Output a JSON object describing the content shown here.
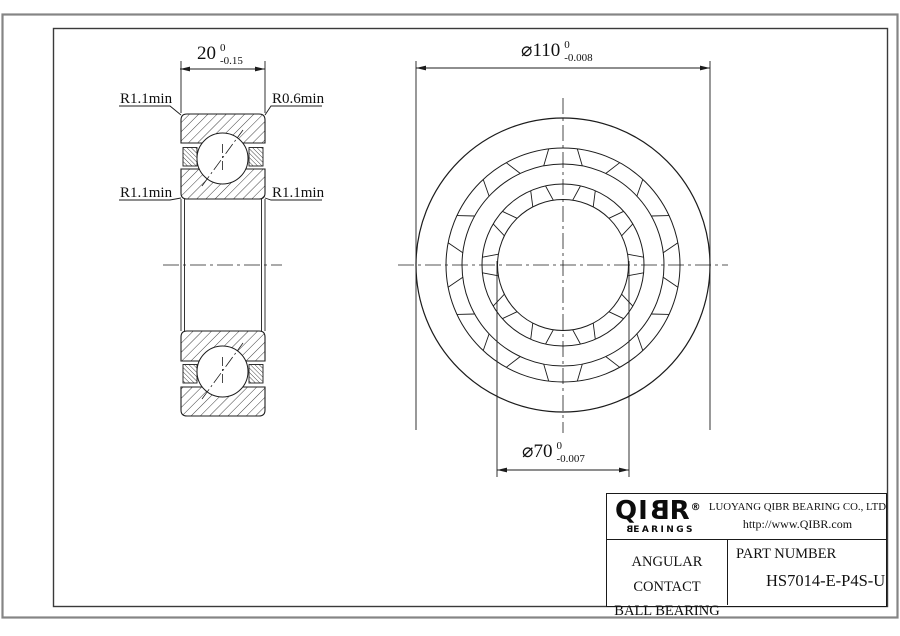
{
  "colors": {
    "line": "#1c1c1c",
    "frame_outer": "#858585",
    "frame_inner": "#3a3a3a"
  },
  "left_view": {
    "width_dim": {
      "value": "20",
      "tol_upper": "0",
      "tol_lower": "-0.15"
    },
    "fillet_top_left": "R1.1min",
    "fillet_top_right": "R0.6min",
    "fillet_mid_left": "R1.1min",
    "fillet_mid_right": "R1.1min"
  },
  "front_view": {
    "od_dim": {
      "value": "⌀110",
      "tol_upper": "0",
      "tol_lower": "-0.008"
    },
    "bore_dim": {
      "value": "⌀70",
      "tol_upper": "0",
      "tol_lower": "-0.007"
    }
  },
  "title_block": {
    "logo": {
      "name": "QIBR",
      "registered": "®",
      "sub": "BEARINGS"
    },
    "company": "LUOYANG QIBR BEARING CO., LTD",
    "website": "http://www.QIBR.com",
    "product": {
      "line1": "ANGULAR CONTACT",
      "line2": "BALL BEARING"
    },
    "part_label": "PART NUMBER",
    "part_number": "HS7014-E-P4S-U"
  }
}
